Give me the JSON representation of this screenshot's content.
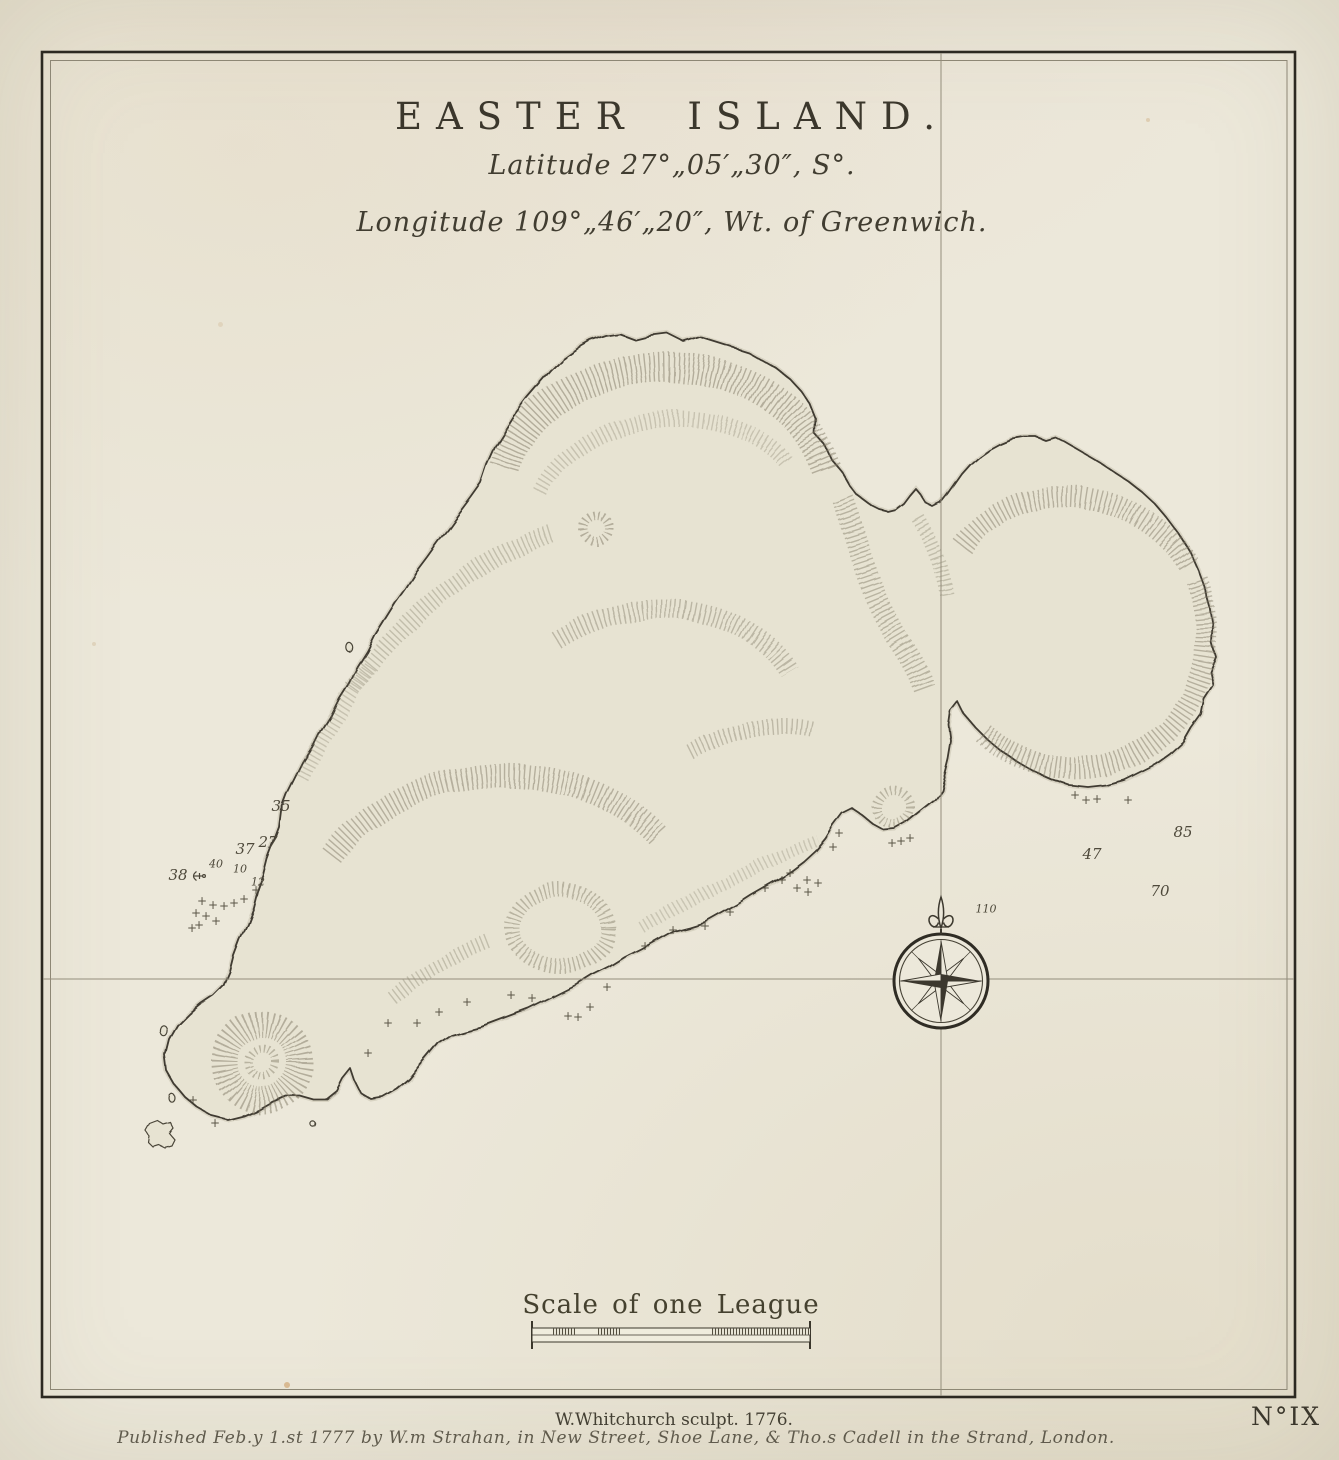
{
  "map": {
    "title": "EASTER ISLAND.",
    "latitude_line": "Latitude 27°„05′„30″, S°.",
    "longitude_line": "Longitude 109°„46′„20″, Wt. of Greenwich.",
    "scale_label": "Scale of one League",
    "engraver_credit": "W.Whitchurch sculpt. 1776.",
    "publication_line": "Published Feb.y 1.st 1777 by W.m Strahan, in New Street, Shoe Lane, & Tho.s Cadell in the Strand, London.",
    "sheet_number": "N°IX",
    "colors": {
      "paper": "#ece8da",
      "ink": "#38342a",
      "island_fill": "#e7e3d2",
      "hachure": "#7f7864",
      "graticule": "#948e7c"
    },
    "soundings": [
      {
        "value": "35",
        "x": 281,
        "y": 806,
        "size": "m"
      },
      {
        "value": "27",
        "x": 268,
        "y": 842,
        "size": "m"
      },
      {
        "value": "37",
        "x": 245,
        "y": 849,
        "size": "m"
      },
      {
        "value": "40",
        "x": 216,
        "y": 864,
        "size": "s"
      },
      {
        "value": "10",
        "x": 240,
        "y": 869,
        "size": "s"
      },
      {
        "value": "38",
        "x": 178,
        "y": 875,
        "size": "m"
      },
      {
        "value": "12",
        "x": 258,
        "y": 882,
        "size": "s"
      },
      {
        "value": "85",
        "x": 1183,
        "y": 832,
        "size": "m"
      },
      {
        "value": "47",
        "x": 1092,
        "y": 854,
        "size": "m"
      },
      {
        "value": "70",
        "x": 1160,
        "y": 891,
        "size": "m"
      },
      {
        "value": "110",
        "x": 986,
        "y": 909,
        "size": "s"
      }
    ],
    "rocks": [
      {
        "x": 202,
        "y": 901
      },
      {
        "x": 213,
        "y": 905
      },
      {
        "x": 224,
        "y": 906
      },
      {
        "x": 234,
        "y": 903
      },
      {
        "x": 244,
        "y": 899
      },
      {
        "x": 196,
        "y": 913
      },
      {
        "x": 206,
        "y": 916
      },
      {
        "x": 216,
        "y": 921
      },
      {
        "x": 199,
        "y": 925
      },
      {
        "x": 192,
        "y": 928
      },
      {
        "x": 256,
        "y": 890
      },
      {
        "x": 193,
        "y": 1100
      },
      {
        "x": 215,
        "y": 1123
      },
      {
        "x": 368,
        "y": 1053
      },
      {
        "x": 388,
        "y": 1023
      },
      {
        "x": 417,
        "y": 1023
      },
      {
        "x": 439,
        "y": 1012
      },
      {
        "x": 467,
        "y": 1002
      },
      {
        "x": 511,
        "y": 995
      },
      {
        "x": 532,
        "y": 998
      },
      {
        "x": 568,
        "y": 1016
      },
      {
        "x": 578,
        "y": 1017
      },
      {
        "x": 590,
        "y": 1007
      },
      {
        "x": 607,
        "y": 987
      },
      {
        "x": 645,
        "y": 946
      },
      {
        "x": 673,
        "y": 930
      },
      {
        "x": 705,
        "y": 926
      },
      {
        "x": 730,
        "y": 912
      },
      {
        "x": 765,
        "y": 888
      },
      {
        "x": 782,
        "y": 880
      },
      {
        "x": 790,
        "y": 873
      },
      {
        "x": 797,
        "y": 888
      },
      {
        "x": 807,
        "y": 880
      },
      {
        "x": 808,
        "y": 892
      },
      {
        "x": 818,
        "y": 883
      },
      {
        "x": 833,
        "y": 847
      },
      {
        "x": 839,
        "y": 833
      },
      {
        "x": 892,
        "y": 843
      },
      {
        "x": 901,
        "y": 841
      },
      {
        "x": 910,
        "y": 838
      },
      {
        "x": 1075,
        "y": 795
      },
      {
        "x": 1086,
        "y": 800
      },
      {
        "x": 1097,
        "y": 799
      },
      {
        "x": 1128,
        "y": 800
      }
    ]
  }
}
